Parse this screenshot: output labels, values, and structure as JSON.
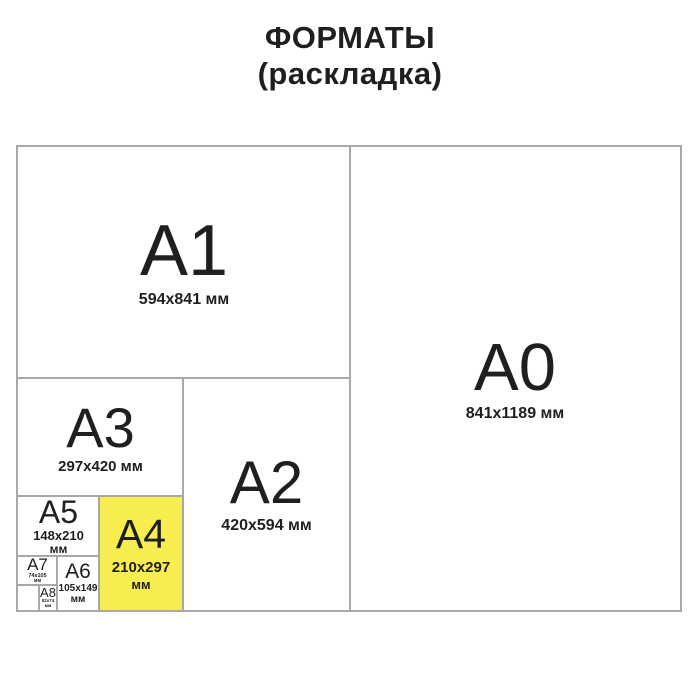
{
  "title": {
    "line1": "ФОРМАТЫ",
    "line2": "(раскладка)"
  },
  "colors": {
    "a4_highlight": "#f7ed51",
    "grid_line": "#a8a8a8",
    "text": "#1f1f1f"
  },
  "formats": {
    "a0": {
      "label": "A0",
      "dimensions": "841x1189 мм"
    },
    "a1": {
      "label": "A1",
      "dimensions": "594x841 мм"
    },
    "a2": {
      "label": "A2",
      "dimensions": "420x594 мм"
    },
    "a3": {
      "label": "A3",
      "dimensions": "297x420 мм"
    },
    "a4": {
      "label": "A4",
      "dimensions": "210x297",
      "unit": "мм"
    },
    "a5": {
      "label": "A5",
      "dimensions": "148x210",
      "unit": "мм"
    },
    "a6": {
      "label": "A6",
      "dimensions": "105x149",
      "unit": "мм"
    },
    "a7": {
      "label": "A7",
      "dimensions": "74x105",
      "unit": "мм"
    },
    "a8": {
      "label": "A8",
      "dimensions": "52x74",
      "unit": "мм"
    }
  }
}
